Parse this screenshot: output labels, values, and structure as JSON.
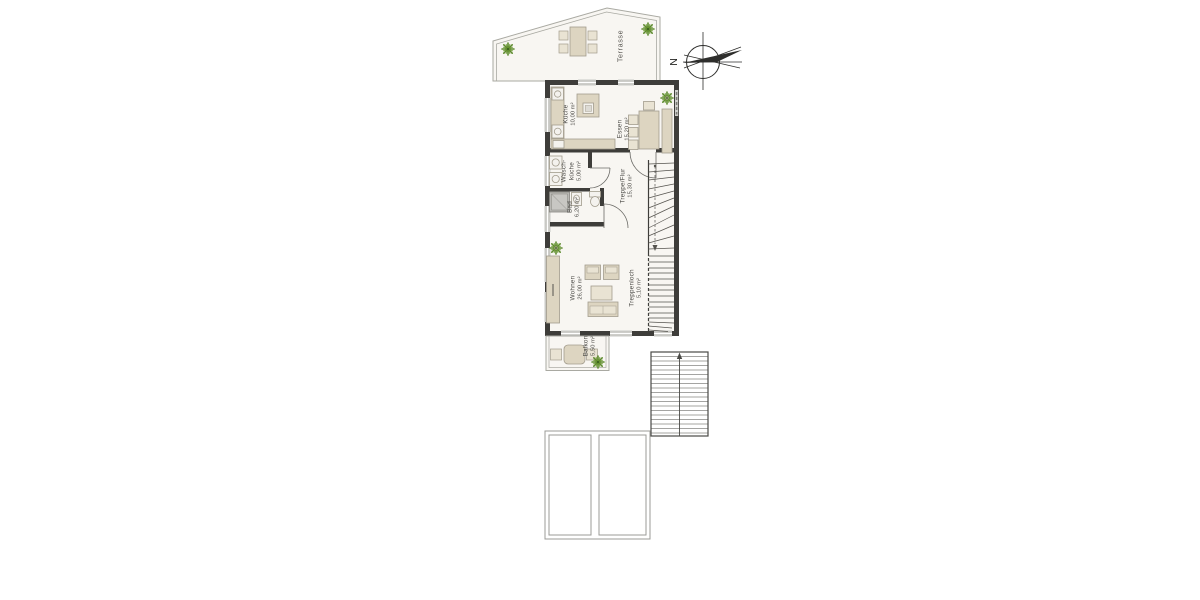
{
  "compass": {
    "north_label": "N"
  },
  "rooms": [
    {
      "name": "Terrasse",
      "area": ""
    },
    {
      "name": "Küche",
      "area": "10,00 m²"
    },
    {
      "name": "Essen",
      "area": "15,20 m²"
    },
    {
      "name": "Wasch-küche",
      "area": "5,00 m²"
    },
    {
      "name": "Bad",
      "area": "6,20 m²"
    },
    {
      "name": "Treppe/Flur",
      "area": "15,30 m²"
    },
    {
      "name": "Wohnen",
      "area": "26,00 m²"
    },
    {
      "name": "Treppenloch",
      "area": "5,10 m²"
    },
    {
      "name": "Balkon",
      "area": "5,50 m²"
    }
  ],
  "colors": {
    "wall": "#3e3d3a",
    "floor": "#f8f6f2",
    "furniture": "#ddd5c1",
    "furniture_light": "#e9e3d3",
    "furniture_outline": "#a29c8d",
    "window": "#c9c9c5",
    "stair_line": "#55534e",
    "plant": "#5d8a2e",
    "text": "#4b4a46"
  }
}
